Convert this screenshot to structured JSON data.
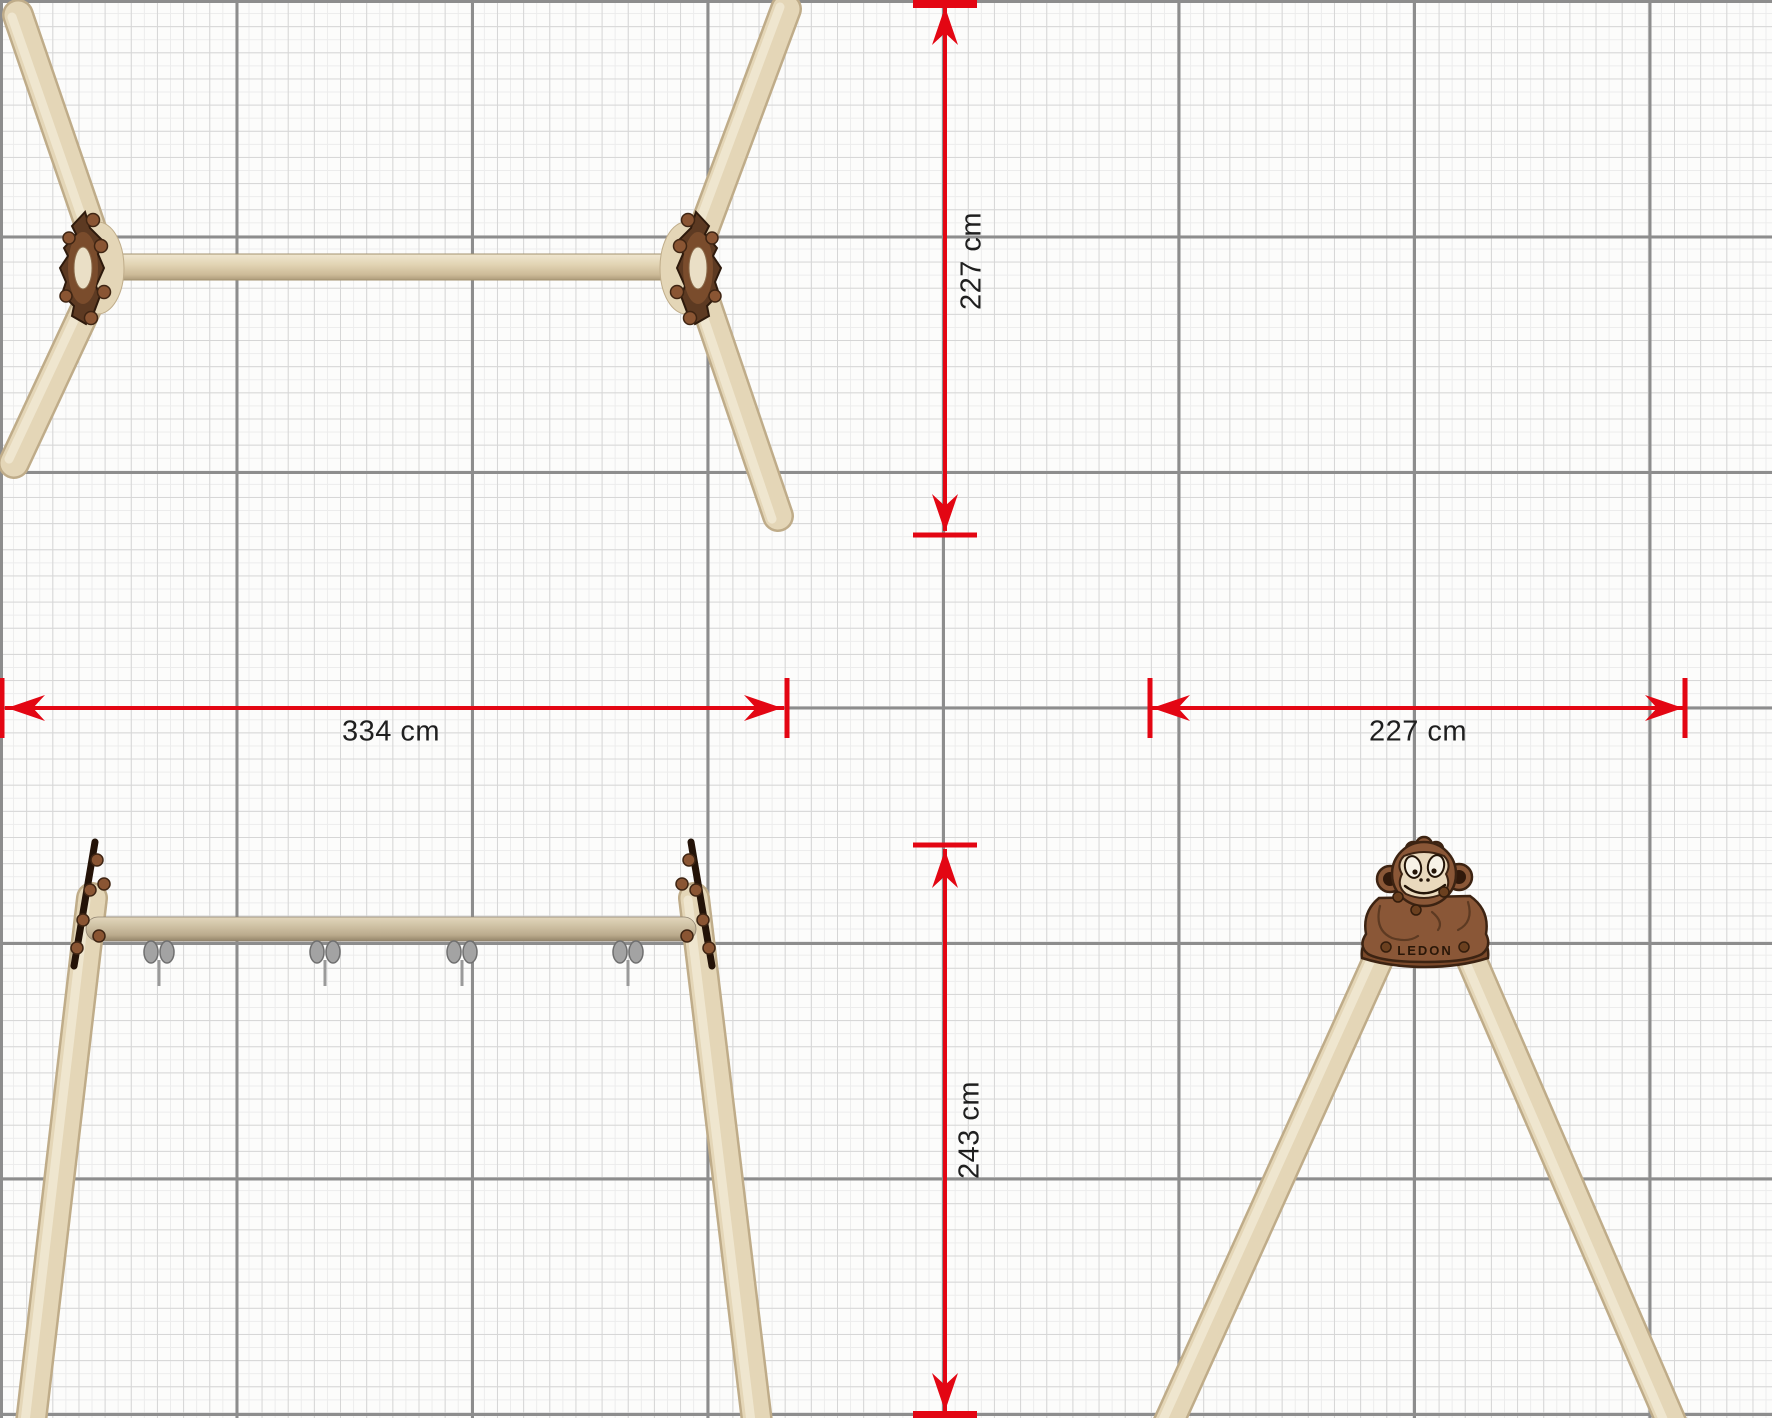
{
  "dimension_labels": {
    "top_view_depth": "227 cm",
    "front_view_width": "334 cm",
    "side_view_width": "227 cm",
    "side_view_height": "243 cm"
  },
  "logo": {
    "brand": "LEDON"
  },
  "colors": {
    "dimension_red": "#E30613",
    "label_text": "#1F1F1F",
    "background": "#FCFCFB",
    "grid_major": "#8D8D8D",
    "grid_minor": "#D6D6D6",
    "grid_fine": "#ECECEC",
    "wood_light": "#E4D6B7",
    "wood_edge": "#BFAC89",
    "plate_dark_brown": "#5D3A22",
    "plate_outline": "#2E1A0C",
    "monkey_brown": "#8A5737",
    "monkey_face": "#E9D9BD",
    "metal_gray": "#A3A3A3"
  }
}
